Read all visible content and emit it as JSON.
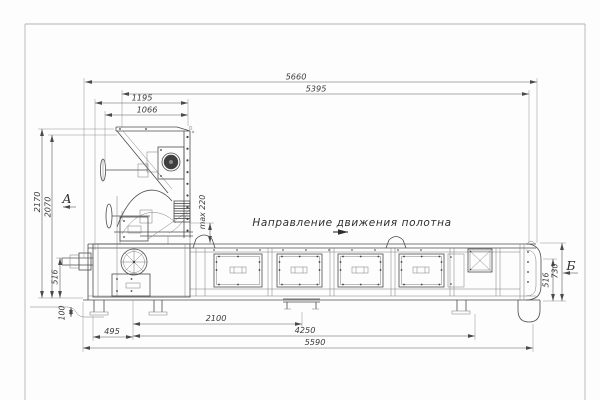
{
  "drawing": {
    "direction_label": "Направление движения полотна",
    "views": {
      "a": "А",
      "b": "Б"
    },
    "dimensions": {
      "overall_top": "5660",
      "frame_top": "5395",
      "mill_width": "1195",
      "hopper_width": "1066",
      "overall_height": "2170",
      "hopper_height": "2070",
      "max_clearance": "max 220",
      "drive_height": "516",
      "ground_clearance": "100",
      "drive_offset": "495",
      "section_span": "2100",
      "support_span": "4250",
      "base_length": "5590",
      "tail_belt_height": "516",
      "tail_height": "730"
    },
    "colors": {
      "line": "#4d4d4d",
      "dimension": "#5a5a5a",
      "background": "#fdfdfd"
    }
  }
}
